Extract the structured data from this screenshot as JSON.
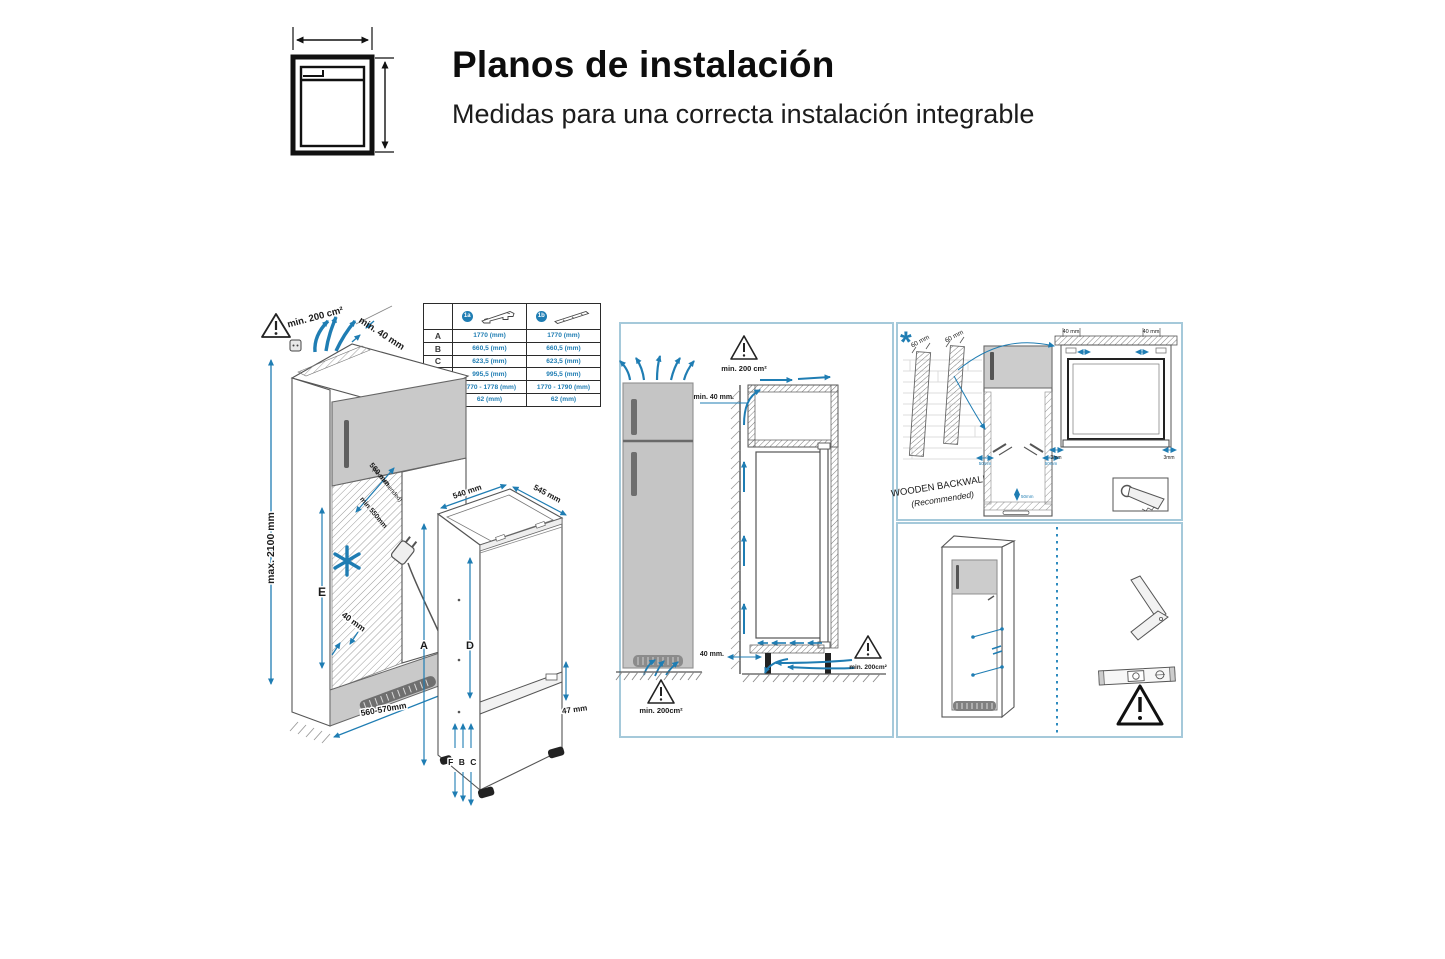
{
  "colors": {
    "accent_blue": "#1f7db3",
    "panel_border": "#a5c9da",
    "fridge_gray": "#c5c5c5",
    "ink": "#111111"
  },
  "header": {
    "title": "Planos de instalación",
    "subtitle": "Medidas para una correcta instalación integrable"
  },
  "dim_table": {
    "badge1": "1a",
    "badge2": "1b",
    "rows": [
      {
        "label": "A",
        "col1": "1770 (mm)",
        "col2": "1770 (mm)"
      },
      {
        "label": "B",
        "col1": "660,5 (mm)",
        "col2": "660,5 (mm)"
      },
      {
        "label": "C",
        "col1": "623,5 (mm)",
        "col2": "623,5 (mm)"
      },
      {
        "label": "D",
        "col1": "995,5 (mm)",
        "col2": "995,5 (mm)"
      },
      {
        "label": "E",
        "col1": "1770 - 1778 (mm)",
        "col2": "1770 - 1790 (mm)"
      },
      {
        "label": "F",
        "col1": "62 (mm)",
        "col2": "62 (mm)"
      }
    ]
  },
  "cabinet": {
    "vent_area": "min. 200 cm²",
    "top_gap": "min. 40 mm",
    "max_height": "max. 2100 mm",
    "inner_height": "E",
    "depth_recommended": "560 mm",
    "depth_recommended_note": "(recommended)",
    "depth_min": "min 550mm",
    "rear_gap": "40 mm",
    "niche_width": "560-570mm"
  },
  "fridge": {
    "width": "540 mm",
    "depth": "545 mm",
    "height": "A",
    "upper_door": "D",
    "door_gap": "47 mm",
    "lower_dims": "F B C"
  },
  "airflow": {
    "top_vent": "min. 200 cm²",
    "top_gap": "min. 40 mm.",
    "base_gap": "40 mm.",
    "front_vent": "min. 200cm²",
    "rear_vent": "min. 200cm²"
  },
  "backwall": {
    "asterisk": "*",
    "post1_width": "60 mm",
    "post2_width": "60 mm",
    "caption": "WOODEN BACKWALL",
    "caption_note": "(Recommended)",
    "top_clearance_left": "40 mm",
    "top_clearance_right": "40 mm",
    "side_clearance_left": "3mm",
    "side_clearance_right": "3mm",
    "screw_offset_left": "50mm",
    "screw_offset_right": "50mm",
    "screw_offset_bottom": "50mm"
  }
}
